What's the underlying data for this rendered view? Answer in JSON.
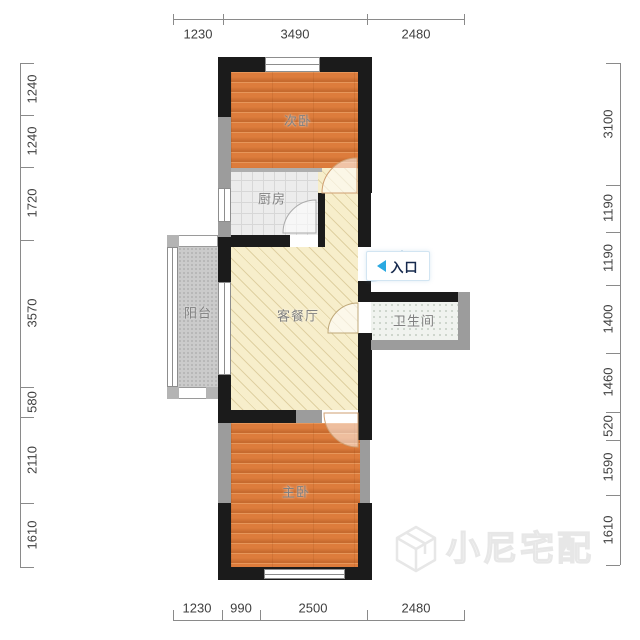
{
  "plan": {
    "rooms": {
      "bedroom2": {
        "label": "次卧"
      },
      "kitchen": {
        "label": "厨房"
      },
      "balcony": {
        "label": "阳台"
      },
      "living": {
        "label": "客餐厅"
      },
      "bathroom": {
        "label": "卫生间"
      },
      "bedroom1": {
        "label": "主卧"
      }
    },
    "entrance": {
      "label": "入口"
    },
    "dims": {
      "top": [
        "1230",
        "3490",
        "2480"
      ],
      "bottom": [
        "1230",
        "990",
        "2500",
        "2480"
      ],
      "left": [
        "1240",
        "1240",
        "1720",
        "3570",
        "580",
        "2110",
        "1610"
      ],
      "right": [
        "3100",
        "1190",
        "1190",
        "1400",
        "1460",
        "520",
        "1590",
        "1610"
      ]
    },
    "watermark": {
      "text": "小尼宅配"
    },
    "colors": {
      "wall_black": "#1b1b1b",
      "wall_gray": "#9c9c9c",
      "wood_floor": "#dd7c3c",
      "living_floor": "#f7eecb",
      "kitchen_floor": "#ececec",
      "bathroom_floor": "#f0f3ef",
      "balcony_floor": "#cbcbcb",
      "entrance_arrow": "#2aa9e1",
      "dim_text": "#3f3f3f"
    }
  }
}
